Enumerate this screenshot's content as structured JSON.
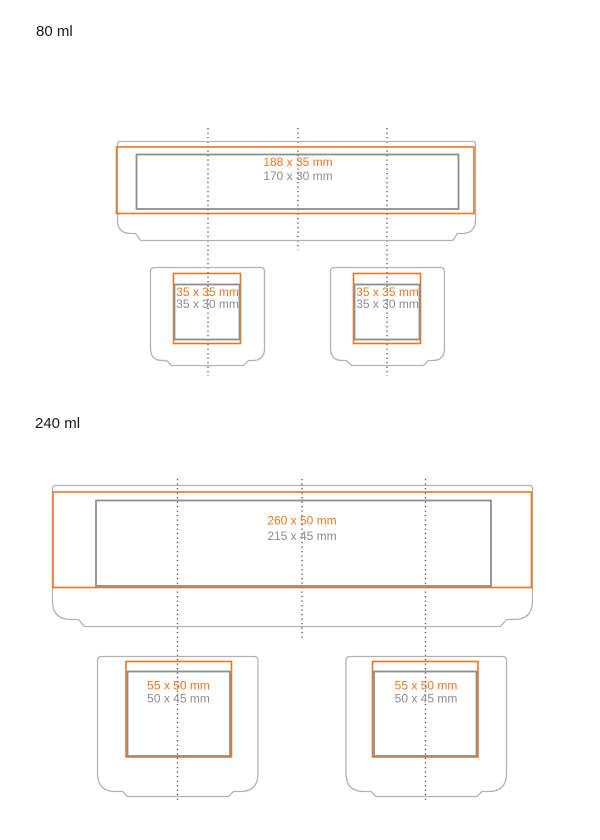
{
  "sections": [
    {
      "label": "80 ml",
      "large": {
        "print": "188 x 35 mm",
        "safe": "170 x 30 mm"
      },
      "small": {
        "print": "35 x 35 mm",
        "safe": "35 x 30 mm"
      }
    },
    {
      "label": "240 ml",
      "large": {
        "print": "260 x 50 mm",
        "safe": "215 x 45 mm"
      },
      "small": {
        "print": "55 x 50 mm",
        "safe": "50 x 45 mm"
      }
    }
  ],
  "colors": {
    "accent": "#EE7623",
    "outline_gray": "#B2B2B2",
    "safe_gray": "#8E8E8E",
    "text_gray": "#8C8C8C",
    "centerline": "#4A4A4A",
    "label_text": "#1A1A1A"
  }
}
